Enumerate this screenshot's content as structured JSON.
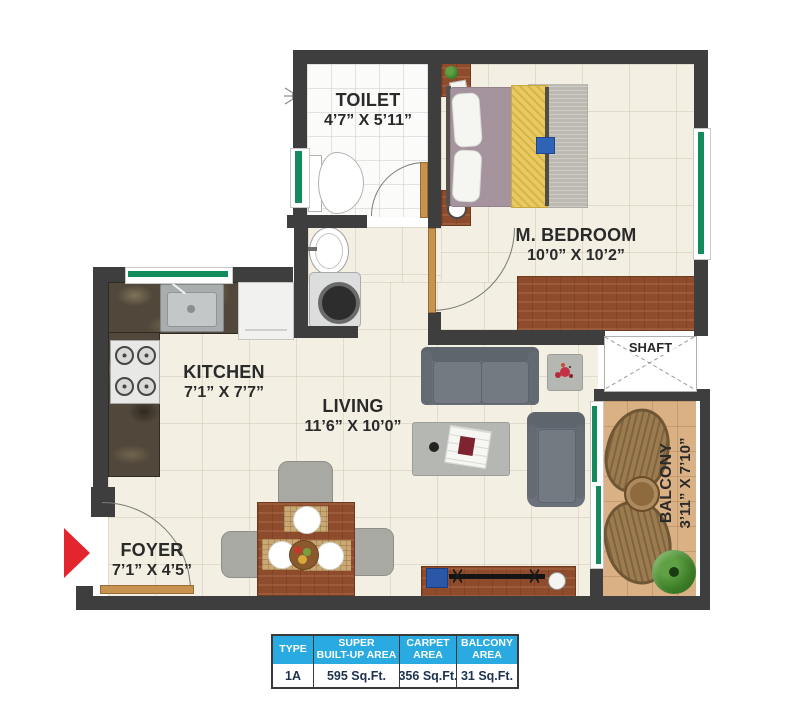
{
  "rooms": {
    "toilet": {
      "name": "TOILET",
      "dims": "4’7” X 5’11”"
    },
    "bedroom": {
      "name": "M. BEDROOM",
      "dims": "10’0” X 10’2”"
    },
    "kitchen": {
      "name": "KITCHEN",
      "dims": "7’1” X 7’7”"
    },
    "living": {
      "name": "LIVING",
      "dims": "11’6” X 10’0”"
    },
    "foyer": {
      "name": "FOYER",
      "dims": "7’1” X 4’5”"
    },
    "balcony": {
      "name": "BALCONY",
      "dims": "3’11” X 7’10”"
    },
    "shaft": {
      "name": "SHAFT"
    }
  },
  "area_table": {
    "columns": [
      {
        "line1": "TYPE",
        "line2": ""
      },
      {
        "line1": "SUPER",
        "line2": "BUILT-UP AREA"
      },
      {
        "line1": "CARPET",
        "line2": "AREA"
      },
      {
        "line1": "BALCONY",
        "line2": "AREA"
      }
    ],
    "values": [
      "1A",
      "595 Sq.Ft.",
      "356 Sq.Ft.",
      "31 Sq.Ft."
    ]
  },
  "colors": {
    "wall": "#3e3e3e",
    "window_green": "#148b5c",
    "entry_arrow_red": "#e3252e",
    "table_header_bg": "#29abe2",
    "table_value_text": "#1d3250",
    "floor_cream": "#f3efe3",
    "balcony_floor": "#d9b184",
    "wood_brown": "#8e4c2d"
  },
  "icons": {
    "entry_arrow": "entry-direction-arrow",
    "shower": "shower-icon"
  }
}
